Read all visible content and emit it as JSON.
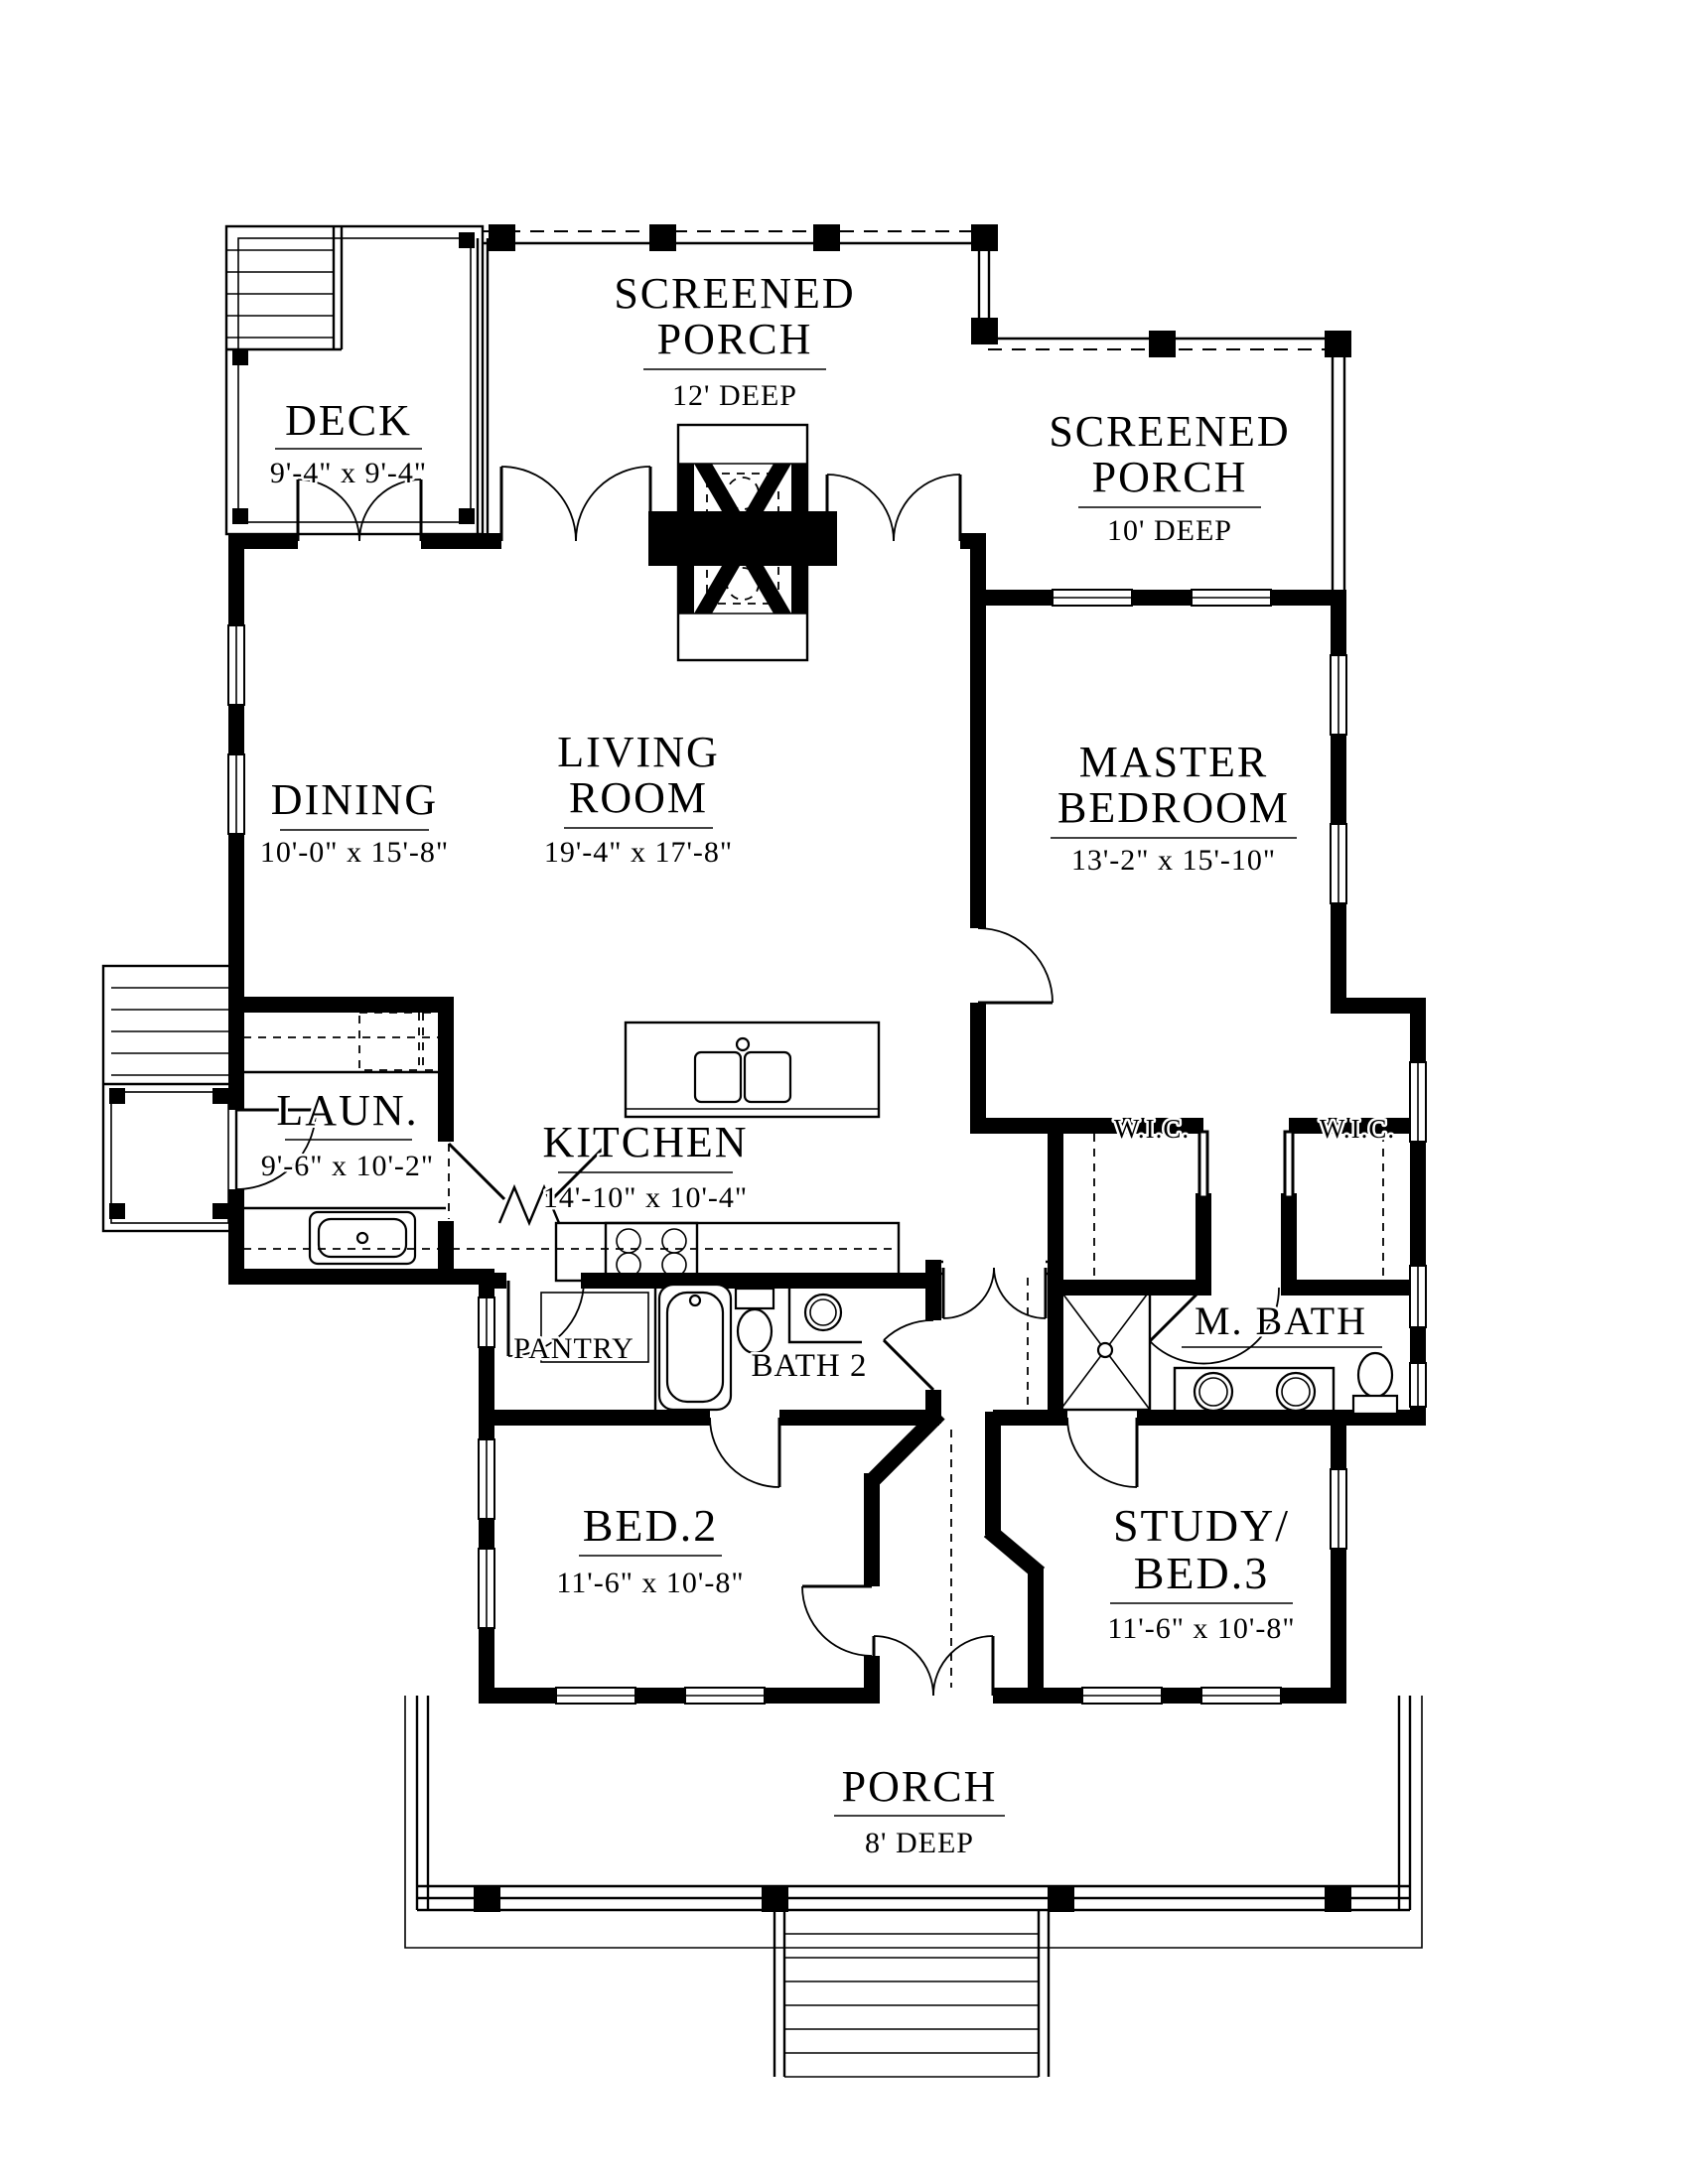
{
  "drawing": {
    "type": "residential floor plan",
    "line_color": "#000000",
    "background_color": "#ffffff"
  },
  "rooms": {
    "screened_porch_top": {
      "line1": "SCREENED",
      "line2": "PORCH",
      "dims": "12' DEEP"
    },
    "deck": {
      "label": "DECK",
      "dims": "9'-4\" x 9'-4\""
    },
    "screened_porch_right": {
      "line1": "SCREENED",
      "line2": "PORCH",
      "dims": "10' DEEP"
    },
    "dining": {
      "label": "DINING",
      "dims": "10'-0\" x 15'-8\""
    },
    "living_room": {
      "line1": "LIVING",
      "line2": "ROOM",
      "dims": "19'-4\" x 17'-8\""
    },
    "master_bedroom": {
      "line1": "MASTER",
      "line2": "BEDROOM",
      "dims": "13'-2\" x 15'-10\""
    },
    "laundry": {
      "label": "LAUN.",
      "dims": "9'-6\" x 10'-2\""
    },
    "kitchen": {
      "label": "KITCHEN",
      "dims": "14'-10\" x 10'-4\""
    },
    "wic_left": {
      "label": "W.I.C."
    },
    "wic_right": {
      "label": "W.I.C."
    },
    "pantry": {
      "label": "PANTRY"
    },
    "bath2": {
      "label": "BATH 2"
    },
    "master_bath": {
      "label": "M. BATH"
    },
    "bed2": {
      "label": "BED.2",
      "dims": "11'-6\" x 10'-8\""
    },
    "study_bed3": {
      "line1": "STUDY/",
      "line2": "BED.3",
      "dims": "11'-6\" x 10'-8\""
    },
    "porch": {
      "label": "PORCH",
      "dims": "8' DEEP"
    }
  }
}
